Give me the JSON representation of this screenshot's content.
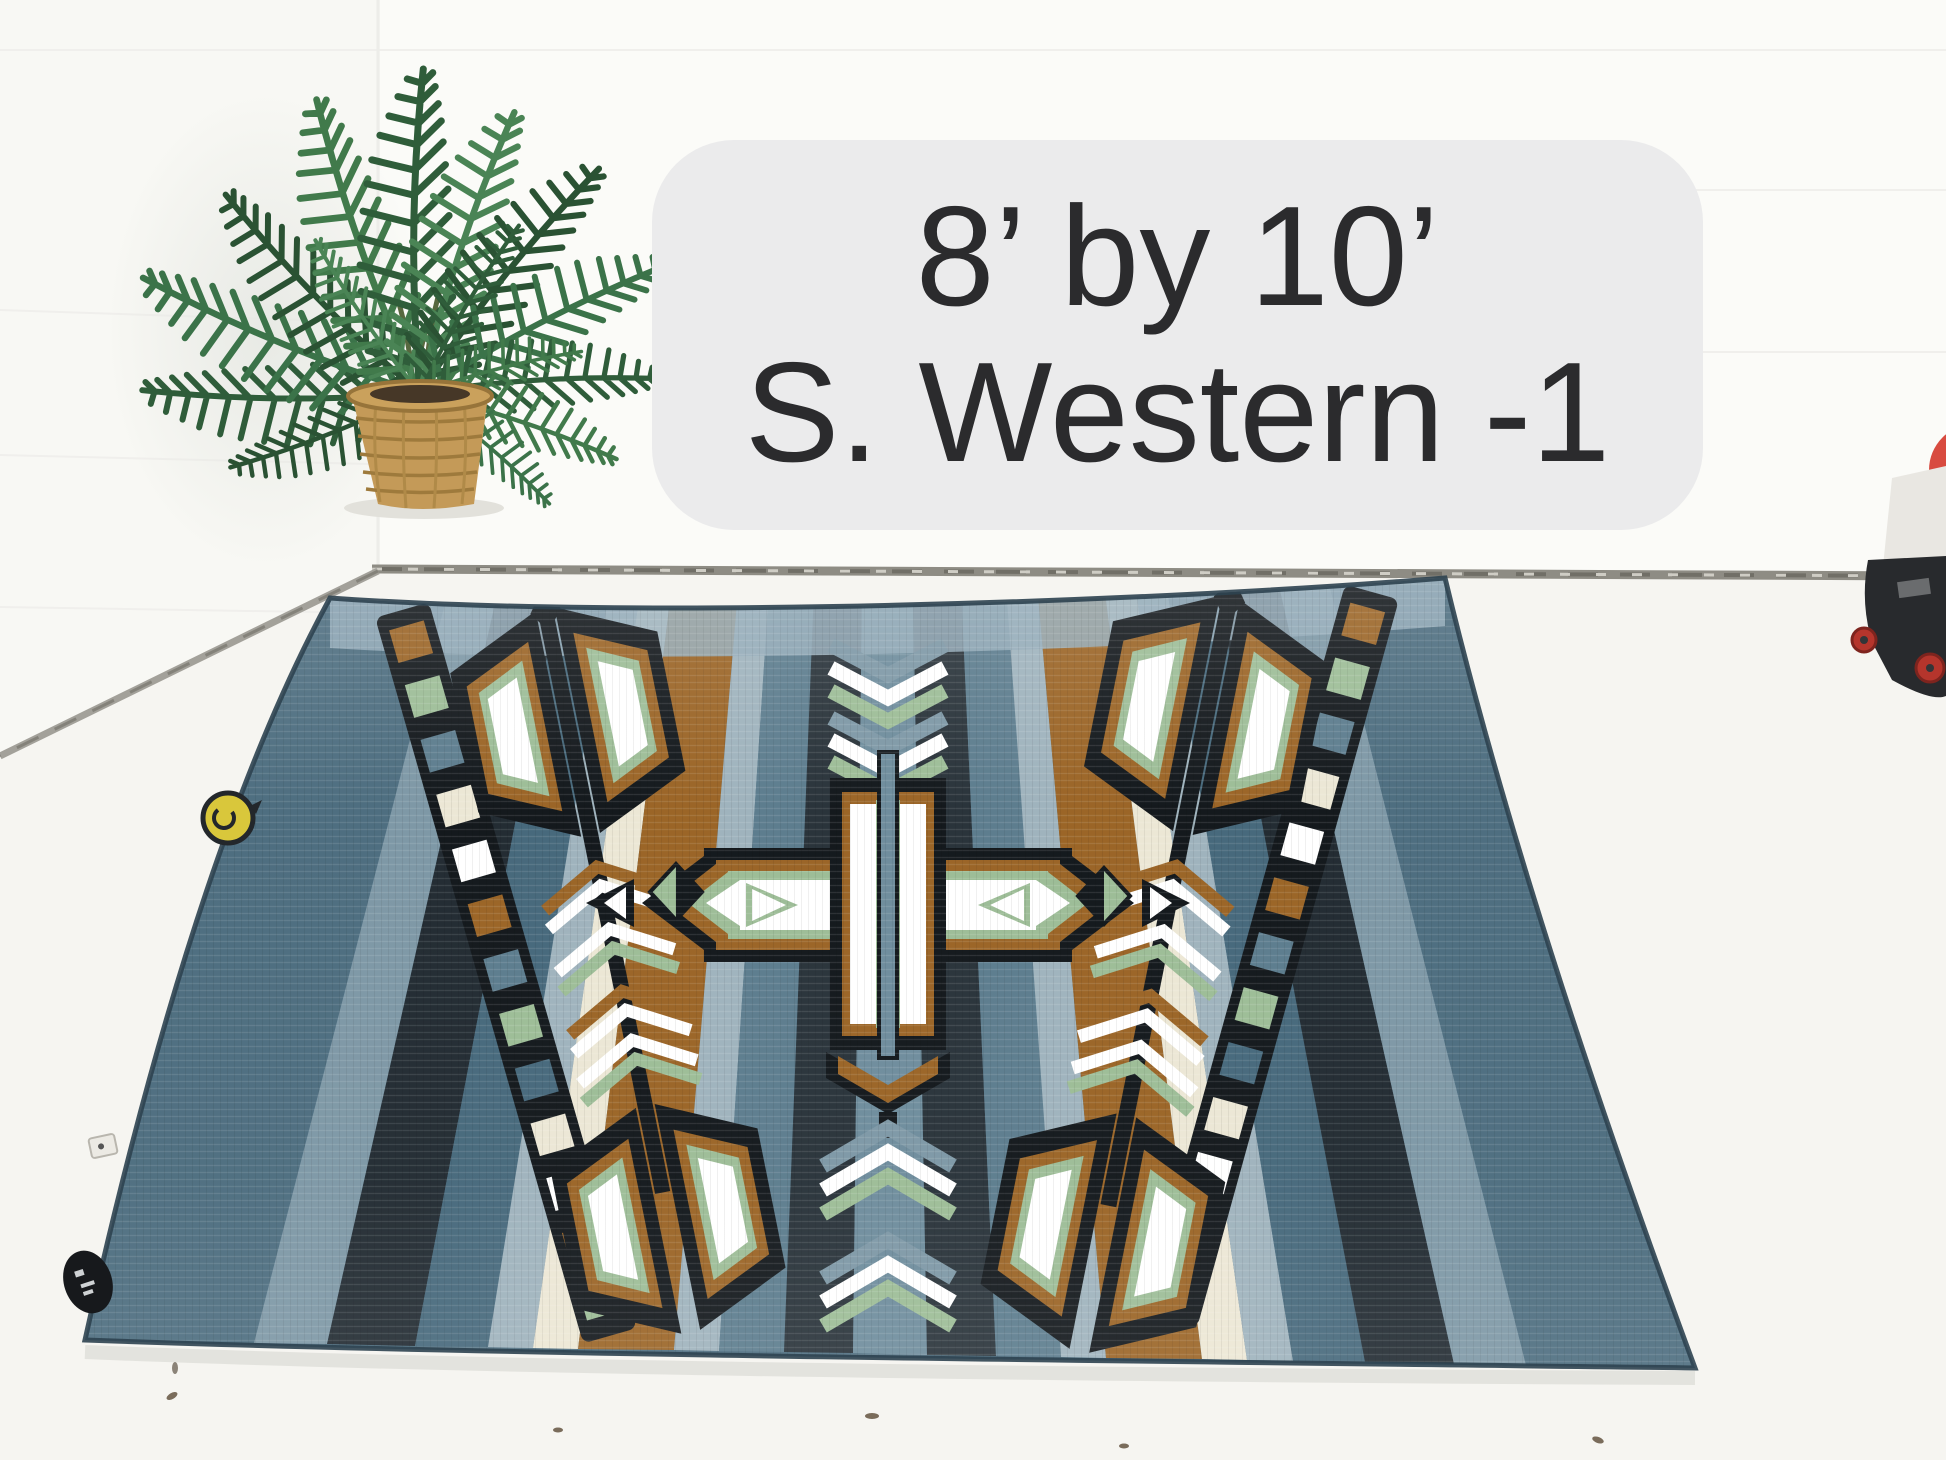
{
  "overlay": {
    "line1": "8’ by 10’",
    "line2": "S. Western -1",
    "bg_color": "#ebebec",
    "text_color": "#2b2b2d"
  },
  "scene": {
    "type": "product photo",
    "setting": "white wall and white floor corner",
    "objects": {
      "plant": "artificial palm in wicker basket",
      "rug": "Southwestern striped area rug laid in perspective",
      "right_edge_items": "red object, white box, black dolly with red caster wheels"
    }
  },
  "rug": {
    "motifs": [
      "striped-field",
      "square-ladder-borders",
      "feather-arrow-left",
      "feather-arrow-right",
      "stepped-diamond-medallion",
      "center-arrow-fletching",
      "diamond-accents"
    ],
    "palette": {
      "slate": "#4e6e80",
      "slate2": "#47697c",
      "gray_blue": "#7e98a6",
      "center_blue": "#6f8d9d",
      "slate_gray": "#5d7d8e",
      "navy": "#232c33",
      "navy2": "#2a343b",
      "light_blue": "#9fb3bd",
      "cream": "#ece7d5",
      "brown": "#9b6527",
      "green": "#9dbd97",
      "black": "#14191d",
      "white": "#ffffff",
      "binding": "#93aab8"
    },
    "tags": [
      "yellow-round-tag",
      "black-oval-tag",
      "white-square-tag"
    ]
  },
  "environment": {
    "wall_color": "#fbfbf8",
    "floor_color": "#f6f5f1",
    "grout_color": "#8e8c84",
    "pot_color": "#c49a58",
    "leaf_greens": [
      "#2f5d3a",
      "#3b7349",
      "#4a8455",
      "#2a5233",
      "#417a4b"
    ]
  }
}
